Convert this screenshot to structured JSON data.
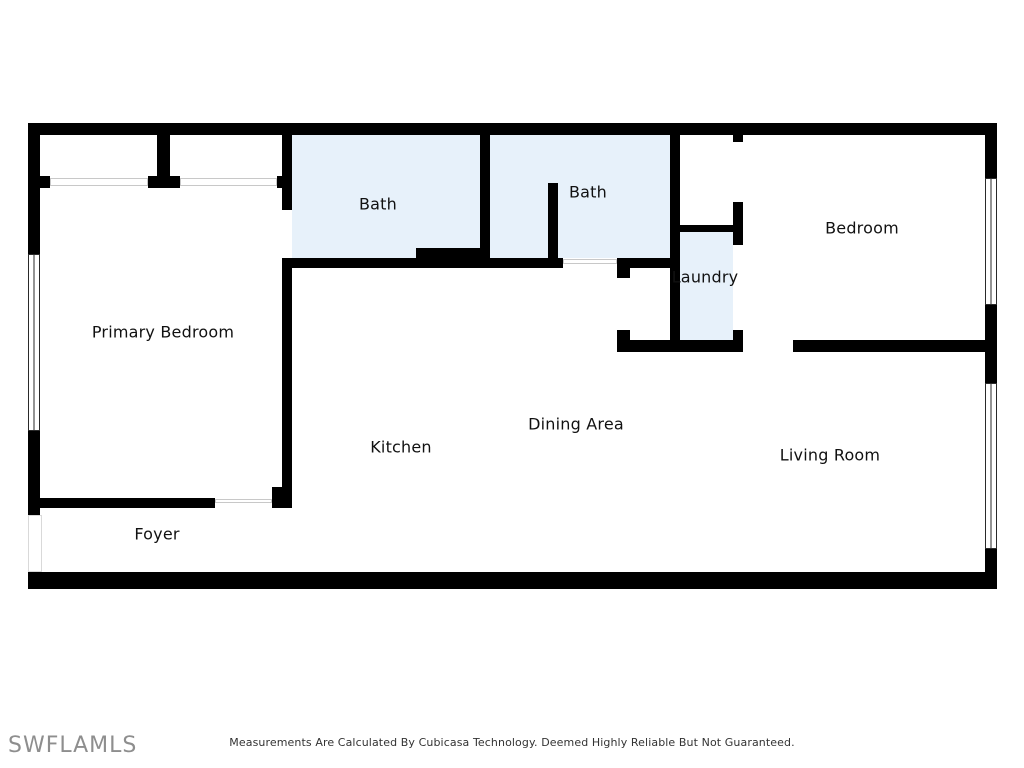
{
  "plan": {
    "title": "Condo floor plan",
    "rooms": [
      {
        "label": "Primary Bedroom"
      },
      {
        "label": "Bath"
      },
      {
        "label": "Bath"
      },
      {
        "label": "Laundry"
      },
      {
        "label": "Bedroom"
      },
      {
        "label": "Kitchen"
      },
      {
        "label": "Dining Area"
      },
      {
        "label": "Living Room"
      },
      {
        "label": "Foyer"
      }
    ],
    "features": [
      "window",
      "window",
      "window",
      "door-openings",
      "closet-sliding-doors"
    ]
  },
  "footer": {
    "watermark": "SWFLAMLS",
    "disclaimer": "Measurements Are Calculated By Cubicasa Technology. Deemed Highly Reliable But Not Guaranteed."
  },
  "colors": {
    "wall": "#000000",
    "wet_room_fill": "#e7f1fa",
    "door_line": "#c8c8c8",
    "window_frame": "#2a2a2a",
    "watermark": "#8e8e8e",
    "disclaimer_text": "#333333"
  }
}
